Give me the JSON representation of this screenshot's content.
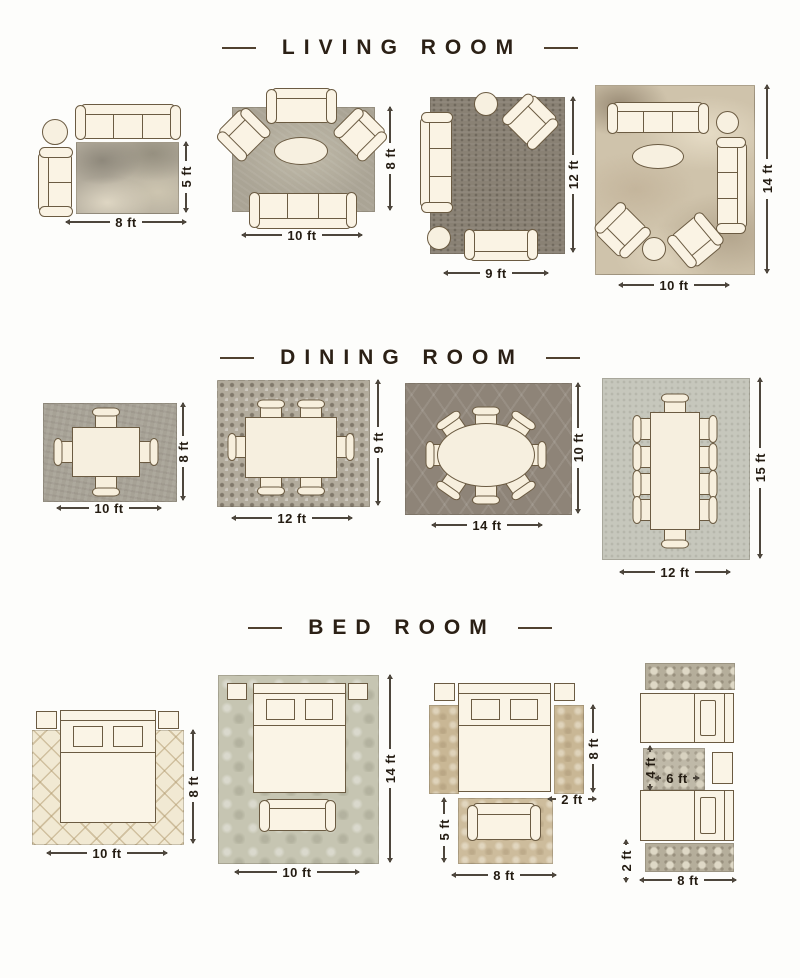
{
  "colors": {
    "accent_text": "#2b2015",
    "furniture_fill": "#faf3e4",
    "furniture_outline": "#6b5b42"
  },
  "sections": [
    {
      "title": "LIVING ROOM",
      "layouts": [
        {
          "width_label": "8 ft",
          "height_label": "5 ft"
        },
        {
          "width_label": "10 ft",
          "height_label": "8 ft"
        },
        {
          "width_label": "9 ft",
          "height_label": "12 ft"
        },
        {
          "width_label": "10 ft",
          "height_label": "14 ft"
        }
      ]
    },
    {
      "title": "DINING ROOM",
      "layouts": [
        {
          "width_label": "10 ft",
          "height_label": "8 ft"
        },
        {
          "width_label": "12 ft",
          "height_label": "9 ft"
        },
        {
          "width_label": "14 ft",
          "height_label": "10 ft"
        },
        {
          "width_label": "12 ft",
          "height_label": "15 ft"
        }
      ]
    },
    {
      "title": "BED ROOM",
      "layouts": [
        {
          "width_label": "10 ft",
          "height_label": "8 ft"
        },
        {
          "width_label": "10 ft",
          "height_label": "14 ft"
        },
        {
          "foot_rug_width_label": "8 ft",
          "foot_rug_height_label": "5 ft",
          "runner_length_label": "8 ft",
          "runner_width_label": "2 ft"
        },
        {
          "runner_length_label": "8 ft",
          "runner_width_label": "2 ft",
          "center_rug_width_label": "6 ft",
          "center_rug_height_label": "4 ft"
        }
      ]
    }
  ]
}
